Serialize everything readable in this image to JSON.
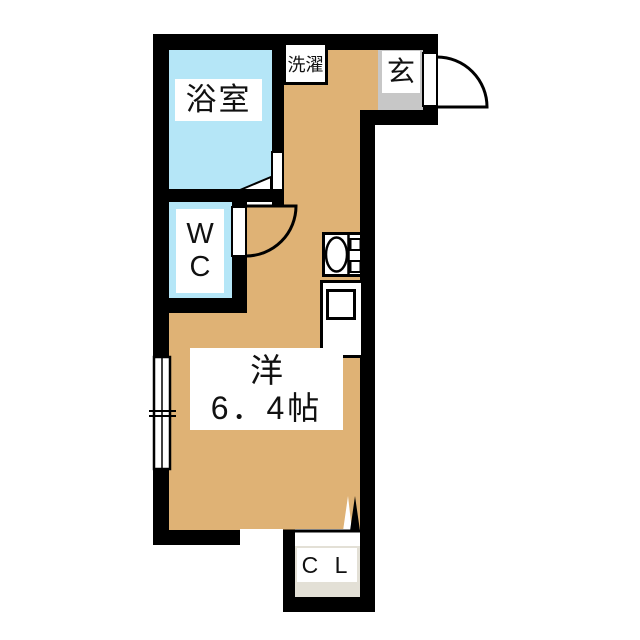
{
  "rooms": {
    "bathroom": {
      "label": "浴室",
      "fill": "#b5e6f7"
    },
    "toilet": {
      "line1": "W",
      "line2": "C",
      "fill": "#b5e6f7"
    },
    "laundry": {
      "label": "洗濯"
    },
    "entrance": {
      "label": "玄",
      "fill": "#c7c7c7"
    },
    "main_room": {
      "name": "洋",
      "size": "6．4帖",
      "fill": "#dfb275"
    },
    "closet": {
      "label": "C L",
      "fill": "#e3e0d6"
    }
  },
  "colors": {
    "wall": "#000000",
    "background": "#ffffff",
    "fixture_fill": "#ffffff",
    "door_outline": "#000000"
  }
}
